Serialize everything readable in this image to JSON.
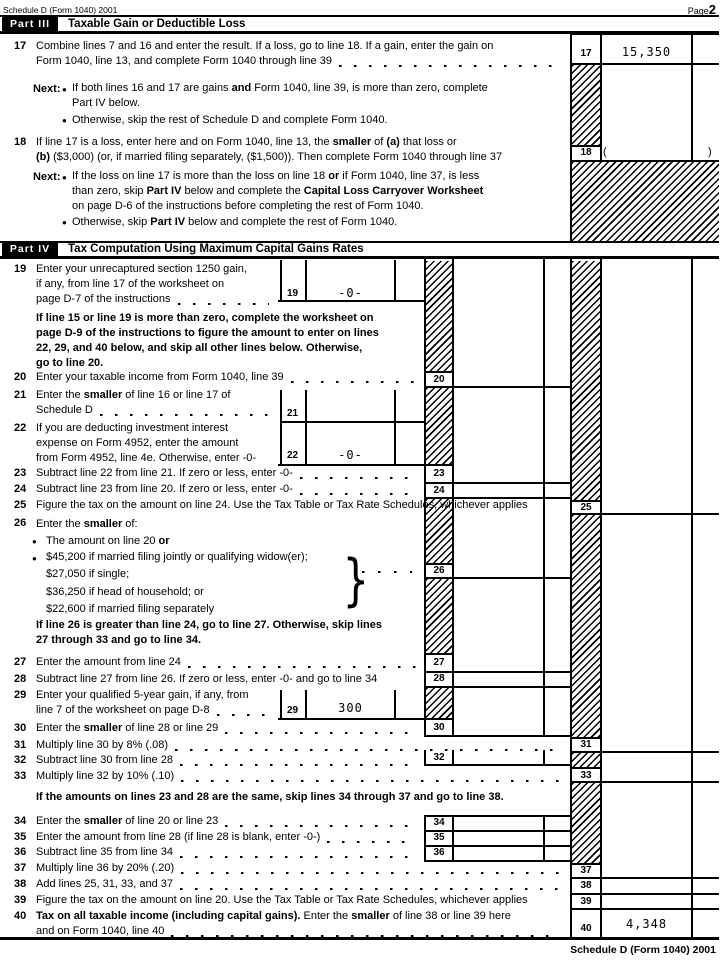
{
  "page": {
    "header_form_id": "Schedule D (Form 1040) 2001",
    "page_word": "Page",
    "page_number": "2",
    "footer_form_id": "Schedule D (Form 1040) 2001"
  },
  "part3": {
    "label": "Part III",
    "title": "Taxable Gain or Deductible Loss"
  },
  "part4": {
    "label": "Part IV",
    "title": "Tax Computation Using Maximum Capital Gains Rates"
  },
  "icons": {
    "bullet": "●",
    "brace": "}"
  },
  "lines": {
    "l17": {
      "no": "17",
      "box_label": "17",
      "value": "15,350",
      "rows": [
        {
          "s": [
            {
              "t": "Combine lines 7 and 16 and enter the result. If a loss, go to line 18. If a gain, enter the gain on"
            }
          ]
        },
        {
          "s": [
            {
              "t": "Form 1040, line 13, and complete Form 1040 through line 39"
            }
          ],
          "leader": true
        }
      ]
    },
    "next17": {
      "label": "Next:",
      "b1": [
        {
          "s": [
            {
              "t": "If both lines 16 and 17 are gains "
            },
            {
              "t": "and",
              "b": true
            },
            {
              "t": " Form 1040, line 39, is more than zero, complete"
            }
          ]
        },
        {
          "s": [
            {
              "t": "Part IV below."
            }
          ]
        }
      ],
      "b2": [
        {
          "t": "Otherwise, skip the rest of Schedule D and complete Form 1040."
        }
      ]
    },
    "l18": {
      "no": "18",
      "box_label": "18",
      "paren_open": "(",
      "paren_close": ")",
      "rows": [
        {
          "s": [
            {
              "t": "If line 17 is a loss, enter here and on Form 1040, line 13, the "
            },
            {
              "t": "smaller",
              "b": true
            },
            {
              "t": " of "
            },
            {
              "t": "(a)",
              "b": true
            },
            {
              "t": " that loss or"
            }
          ]
        },
        {
          "s": [
            {
              "t": "(b)",
              "b": true
            },
            {
              "t": " ($3,000) (or, if married filing separately, ($1,500)). Then complete Form 1040 through line 37"
            }
          ]
        }
      ]
    },
    "next18": {
      "label": "Next:",
      "b1": [
        {
          "s": [
            {
              "t": "If the loss on line 17 is more than the loss on line 18 "
            },
            {
              "t": "or",
              "b": true
            },
            {
              "t": " if Form 1040, line 37, is less"
            }
          ]
        },
        {
          "s": [
            {
              "t": "than zero, skip "
            },
            {
              "t": "Part IV",
              "b": true
            },
            {
              "t": " below and complete the "
            },
            {
              "t": "Capital Loss Carryover Worksheet",
              "b": true
            }
          ]
        },
        {
          "s": [
            {
              "t": "on page D-6 of the instructions before completing the rest of Form 1040."
            }
          ]
        }
      ],
      "b2": [
        {
          "t": "Otherwise, skip "
        },
        {
          "t": "Part IV",
          "b": true
        },
        {
          "t": " below and complete the rest of Form 1040."
        }
      ]
    },
    "l19": {
      "no": "19",
      "box_label": "19",
      "value": "-0-",
      "rows": [
        {
          "s": [
            {
              "t": "Enter your unrecaptured section 1250 gain,"
            }
          ]
        },
        {
          "s": [
            {
              "t": "if any, from line 17 of the worksheet on"
            }
          ]
        },
        {
          "s": [
            {
              "t": "page D-7 of the instructions"
            }
          ],
          "leader": true
        }
      ]
    },
    "note19": {
      "rows": [
        {
          "s": [
            {
              "t": "If line 15 or line 19 is more than zero, complete the worksheet on",
              "b": true
            }
          ]
        },
        {
          "s": [
            {
              "t": "page D-9 of the instructions to figure the amount to enter on lines",
              "b": true
            }
          ]
        },
        {
          "s": [
            {
              "t": "22, 29, and 40 below, and skip all other lines below. Otherwise,",
              "b": true
            }
          ]
        },
        {
          "s": [
            {
              "t": "go to line 20.",
              "b": true
            }
          ]
        }
      ]
    },
    "l20": {
      "no": "20",
      "box_label": "20",
      "rows": [
        {
          "s": [
            {
              "t": "Enter your taxable income from Form 1040, line 39"
            }
          ],
          "leader": true
        }
      ]
    },
    "l21": {
      "no": "21",
      "box_label": "21",
      "rows": [
        {
          "s": [
            {
              "t": "Enter the "
            },
            {
              "t": "smaller",
              "b": true
            },
            {
              "t": " of line 16 or line 17 of"
            }
          ]
        },
        {
          "s": [
            {
              "t": "Schedule D"
            }
          ],
          "leader": true
        }
      ]
    },
    "l22": {
      "no": "22",
      "box_label": "22",
      "value": "-0-",
      "rows": [
        {
          "s": [
            {
              "t": "If you are deducting investment interest"
            }
          ]
        },
        {
          "s": [
            {
              "t": "expense on Form 4952, enter the amount"
            }
          ]
        },
        {
          "s": [
            {
              "t": "from Form 4952, line 4e. Otherwise, enter -0-"
            }
          ]
        }
      ]
    },
    "l23": {
      "no": "23",
      "box_label": "23",
      "rows": [
        {
          "s": [
            {
              "t": "Subtract line 22 from line 21. If zero or less, enter -0-"
            }
          ],
          "leader": true
        }
      ]
    },
    "l24": {
      "no": "24",
      "box_label": "24",
      "rows": [
        {
          "s": [
            {
              "t": "Subtract line 23 from line 20. If zero or less, enter -0-"
            }
          ],
          "leader": true
        }
      ]
    },
    "l25": {
      "no": "25",
      "box_label": "25",
      "rows": [
        {
          "s": [
            {
              "t": "Figure the tax on the amount on line 24. Use the Tax Table or Tax Rate Schedules, whichever applies"
            }
          ]
        }
      ]
    },
    "l26": {
      "no": "26",
      "box_label": "26",
      "title": [
        {
          "t": "Enter the "
        },
        {
          "t": "smaller",
          "b": true
        },
        {
          "t": " of:"
        }
      ],
      "b1": [
        {
          "t": "The amount on line 20 "
        },
        {
          "t": "or",
          "b": true
        }
      ],
      "b2_rows": [
        {
          "s": [
            {
              "t": "$45,200 if married filing jointly or qualifying widow(er);"
            }
          ]
        },
        {
          "s": [
            {
              "t": "$27,050 if single;"
            }
          ]
        },
        {
          "s": [
            {
              "t": "$36,250 if head of household; or"
            }
          ]
        },
        {
          "s": [
            {
              "t": "$22,600 if married filing separately"
            }
          ]
        }
      ]
    },
    "note26": {
      "rows": [
        {
          "s": [
            {
              "t": "If line 26 is greater than line 24, go to line 27. Otherwise, skip lines",
              "b": true
            }
          ]
        },
        {
          "s": [
            {
              "t": "27 through 33 and go to line 34.",
              "b": true
            }
          ]
        }
      ]
    },
    "l27": {
      "no": "27",
      "box_label": "27",
      "rows": [
        {
          "s": [
            {
              "t": "Enter the amount from line 24"
            }
          ],
          "leader": true
        }
      ]
    },
    "l28": {
      "no": "28",
      "box_label": "28",
      "rows": [
        {
          "s": [
            {
              "t": "Subtract line 27 from line 26. If zero or less, enter -0- and go to line 34"
            }
          ]
        }
      ]
    },
    "l29": {
      "no": "29",
      "box_label": "29",
      "value": "300",
      "rows": [
        {
          "s": [
            {
              "t": "Enter your qualified 5-year gain, if any, from"
            }
          ]
        },
        {
          "s": [
            {
              "t": "line 7 of the worksheet on page D-8"
            }
          ],
          "leader": true
        }
      ]
    },
    "l30": {
      "no": "30",
      "box_label": "30",
      "rows": [
        {
          "s": [
            {
              "t": "Enter the "
            },
            {
              "t": "smaller",
              "b": true
            },
            {
              "t": " of line 28 or line 29"
            }
          ],
          "leader": true
        }
      ]
    },
    "l31": {
      "no": "31",
      "box_label": "31",
      "rows": [
        {
          "s": [
            {
              "t": "Multiply line 30 by 8% (.08)"
            }
          ],
          "leader": true
        }
      ]
    },
    "l32": {
      "no": "32",
      "box_label": "32",
      "rows": [
        {
          "s": [
            {
              "t": "Subtract line 30 from line 28"
            }
          ],
          "leader": true
        }
      ]
    },
    "l33": {
      "no": "33",
      "box_label": "33",
      "rows": [
        {
          "s": [
            {
              "t": "Multiply line 32 by 10% (.10)"
            }
          ],
          "leader": true
        }
      ]
    },
    "note33": {
      "rows": [
        {
          "s": [
            {
              "t": "If the amounts on lines 23 and 28 are the same, skip lines 34 through 37 and go to line 38.",
              "b": true
            }
          ]
        }
      ]
    },
    "l34": {
      "no": "34",
      "box_label": "34",
      "rows": [
        {
          "s": [
            {
              "t": "Enter the "
            },
            {
              "t": "smaller",
              "b": true
            },
            {
              "t": " of line 20 or line 23"
            }
          ],
          "leader": true
        }
      ]
    },
    "l35": {
      "no": "35",
      "box_label": "35",
      "rows": [
        {
          "s": [
            {
              "t": "Enter the amount from line 28 (if line 28 is blank, enter -0-)"
            }
          ],
          "leader": true
        }
      ]
    },
    "l36": {
      "no": "36",
      "box_label": "36",
      "rows": [
        {
          "s": [
            {
              "t": "Subtract line 35 from line 34"
            }
          ],
          "leader": true
        }
      ]
    },
    "l37": {
      "no": "37",
      "box_label": "37",
      "rows": [
        {
          "s": [
            {
              "t": "Multiply line 36 by 20% (.20)"
            }
          ],
          "leader": true
        }
      ]
    },
    "l38": {
      "no": "38",
      "box_label": "38",
      "rows": [
        {
          "s": [
            {
              "t": "Add lines 25, 31, 33, and 37"
            }
          ],
          "leader": true
        }
      ]
    },
    "l39": {
      "no": "39",
      "box_label": "39",
      "rows": [
        {
          "s": [
            {
              "t": "Figure the tax on the amount on line 20. Use the Tax Table or Tax Rate Schedules, whichever applies"
            }
          ]
        }
      ]
    },
    "l40": {
      "no": "40",
      "box_label": "40",
      "value": "4,348",
      "rows": [
        {
          "s": [
            {
              "t": "Tax on all taxable income (including capital gains).",
              "b": true
            },
            {
              "t": " Enter the "
            },
            {
              "t": "smaller",
              "b": true
            },
            {
              "t": " of line 38 or line 39 here"
            }
          ]
        },
        {
          "s": [
            {
              "t": "and on Form 1040, line 40"
            }
          ],
          "leader": true
        }
      ]
    }
  }
}
